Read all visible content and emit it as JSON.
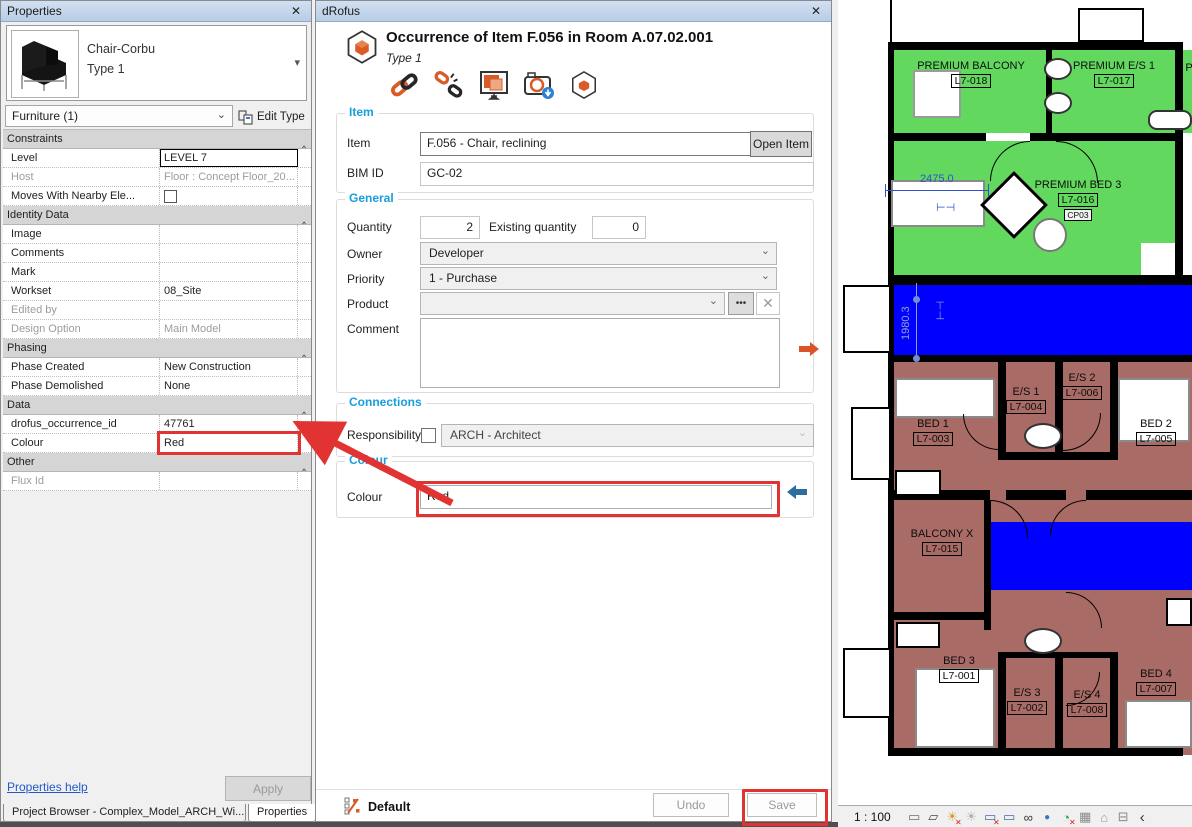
{
  "properties_panel": {
    "title": "Properties",
    "close_glyph": "✕",
    "type_selector": {
      "family": "Chair-Corbu",
      "type": "Type 1"
    },
    "filter_label": "Furniture (1)",
    "edit_type_label": "Edit Type",
    "rows": [
      {
        "label": "Constraints"
      },
      {
        "label": "Level",
        "value": "LEVEL 7"
      },
      {
        "label": "Host",
        "value": "Floor : Concept Floor_20..."
      },
      {
        "label": "Moves With Nearby Ele...",
        "value": ""
      },
      {
        "label": "Identity Data"
      },
      {
        "label": "Image",
        "value": ""
      },
      {
        "label": "Comments",
        "value": ""
      },
      {
        "label": "Mark",
        "value": ""
      },
      {
        "label": "Workset",
        "value": "08_Site"
      },
      {
        "label": "Edited by",
        "value": ""
      },
      {
        "label": "Design Option",
        "value": "Main Model"
      },
      {
        "label": "Phasing"
      },
      {
        "label": "Phase Created",
        "value": "New Construction"
      },
      {
        "label": "Phase Demolished",
        "value": "None"
      },
      {
        "label": "Data"
      },
      {
        "label": "drofus_occurrence_id",
        "value": "47761"
      },
      {
        "label": "Colour",
        "value": "Red"
      },
      {
        "label": "Other"
      },
      {
        "label": "Flux Id",
        "value": ""
      }
    ],
    "help_link": "Properties help",
    "apply_label": "Apply",
    "tabs": [
      {
        "label": "Project Browser - Complex_Model_ARCH_Wi..."
      },
      {
        "label": "Properties"
      }
    ]
  },
  "drofus_panel": {
    "title": "dRofus",
    "close_glyph": "✕",
    "header": {
      "title": "Occurrence of Item F.056 in Room A.07.02.001",
      "subtitle": "Type 1"
    },
    "item_section": {
      "legend": "Item",
      "item_label": "Item",
      "item_value": "F.056 - Chair, reclining",
      "open_item_label": "Open Item",
      "bim_id_label": "BIM ID",
      "bim_id_value": "GC-02"
    },
    "general_section": {
      "legend": "General",
      "quantity_label": "Quantity",
      "quantity_value": "2",
      "existing_quantity_label": "Existing quantity",
      "existing_quantity_value": "0",
      "owner_label": "Owner",
      "owner_value": "Developer",
      "priority_label": "Priority",
      "priority_value": "1 - Purchase",
      "product_label": "Product",
      "product_value": "",
      "product_more_glyph": "•••",
      "product_clear_glyph": "✕",
      "comment_label": "Comment",
      "comment_value": ""
    },
    "connections_section": {
      "legend": "Connections",
      "responsibility_label": "Responsibility",
      "responsibility_value": "ARCH - Architect"
    },
    "colour_section": {
      "legend": "Colour",
      "colour_label": "Colour",
      "colour_value": "Red"
    },
    "footer": {
      "default_label": "Default",
      "undo_label": "Undo",
      "save_label": "Save"
    }
  },
  "plan": {
    "rooms": [
      {
        "name": "PREMIUM BALCONY",
        "tag": "L7-018"
      },
      {
        "name": "PREMIUM E/S 1",
        "tag": "L7-017"
      },
      {
        "name": "PREMIUM BED 3",
        "tag": "L7-016",
        "extra": "CP03"
      },
      {
        "name": "BED 1",
        "tag": "L7-003"
      },
      {
        "name": "E/S 1",
        "tag": "L7-004"
      },
      {
        "name": "E/S 2",
        "tag": "L7-006"
      },
      {
        "name": "BED 2",
        "tag": "L7-005"
      },
      {
        "name": "BALCONY X",
        "tag": "L7-015"
      },
      {
        "name": "BED 3",
        "tag": "L7-001"
      },
      {
        "name": "E/S 3",
        "tag": "L7-002"
      },
      {
        "name": "E/S 4",
        "tag": "L7-008"
      },
      {
        "name": "BED 4",
        "tag": "L7-007"
      },
      {
        "name": "PR"
      }
    ],
    "dimensions": {
      "width": "2475.0",
      "height": "1980.3"
    },
    "colors": {
      "green": "#62d95e",
      "blue": "#0000ff",
      "brown": "#a96b66",
      "highlight": "#e23333"
    },
    "statusbar": {
      "scale": "1 : 100",
      "icons": [
        {
          "name": "crop-region-icon",
          "glyph": "▭"
        },
        {
          "name": "visual-style-icon",
          "glyph": "▱"
        },
        {
          "name": "sun-path-icon",
          "glyph": "☀",
          "badge": "✕"
        },
        {
          "name": "shadows-icon",
          "glyph": "☀"
        },
        {
          "name": "crop-view-icon",
          "glyph": "▭",
          "badge": "✕"
        },
        {
          "name": "show-crop-icon",
          "glyph": "▭"
        },
        {
          "name": "hide-isolate-icon",
          "glyph": "∞"
        },
        {
          "name": "reveal-hidden-icon",
          "glyph": "●"
        },
        {
          "name": "view-properties-icon",
          "glyph": "◔",
          "badge": "✕"
        },
        {
          "name": "analytical-model-icon",
          "glyph": "▦"
        },
        {
          "name": "displacement-icon",
          "glyph": "⌂"
        },
        {
          "name": "lock-icon",
          "glyph": "⊟"
        },
        {
          "name": "collapse-icon",
          "glyph": "‹"
        }
      ]
    }
  }
}
